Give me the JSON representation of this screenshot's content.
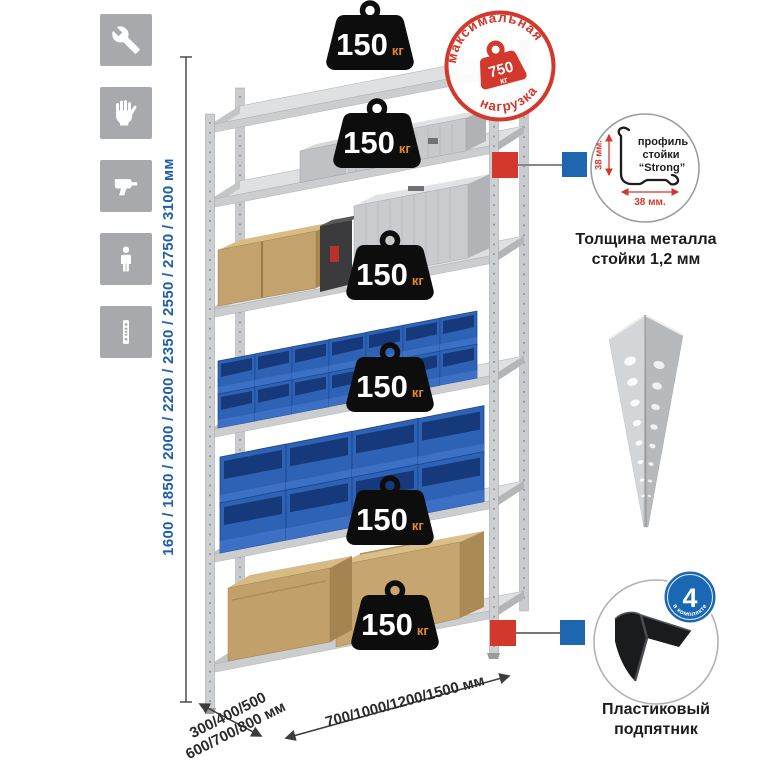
{
  "icons_panel": {
    "items": [
      {
        "name": "wrench"
      },
      {
        "name": "gloves"
      },
      {
        "name": "drill"
      },
      {
        "name": "person"
      },
      {
        "name": "rack-post-profile"
      }
    ]
  },
  "height_dimension": {
    "text": "1600 / 1850 / 2000 / 2200 / 2350 / 2550 / 2750 / 3100 мм"
  },
  "weights": {
    "items": [
      {
        "value": "150",
        "unit": "кг"
      },
      {
        "value": "150",
        "unit": "кг"
      },
      {
        "value": "150",
        "unit": "кг"
      },
      {
        "value": "150",
        "unit": "кг"
      },
      {
        "value": "150",
        "unit": "кг"
      },
      {
        "value": "150",
        "unit": "кг"
      }
    ]
  },
  "max_load_stamp": {
    "arc_top": "максимальная",
    "arc_bottom": "нагрузка",
    "value": "750",
    "unit": "кг"
  },
  "profile_detail": {
    "title_line1": "профиль",
    "title_line2": "стойки",
    "title_line3": "“Strong”",
    "dim_vertical": "38 мм.",
    "dim_horizontal": "38 мм.",
    "caption_line1": "Толщина металла",
    "caption_line2": "стойки 1,2 мм"
  },
  "foot_detail": {
    "badge_value": "4",
    "badge_arc": "в комплекте",
    "caption_line1": "Пластиковый",
    "caption_line2": "подпятник"
  },
  "bottom_dimensions": {
    "depth_line1": "300/400/500",
    "depth_line2": "600/700/800 мм",
    "width_text": "700/1000/1200/1500 мм"
  },
  "colors": {
    "accent_red": "#d2382c",
    "accent_blue": "#1f66b0",
    "dimension_blue": "#1d5fa8",
    "weight_black": "#0d0d0d",
    "unit_orange": "#e2892f",
    "bin_blue": "#2d62b5"
  }
}
